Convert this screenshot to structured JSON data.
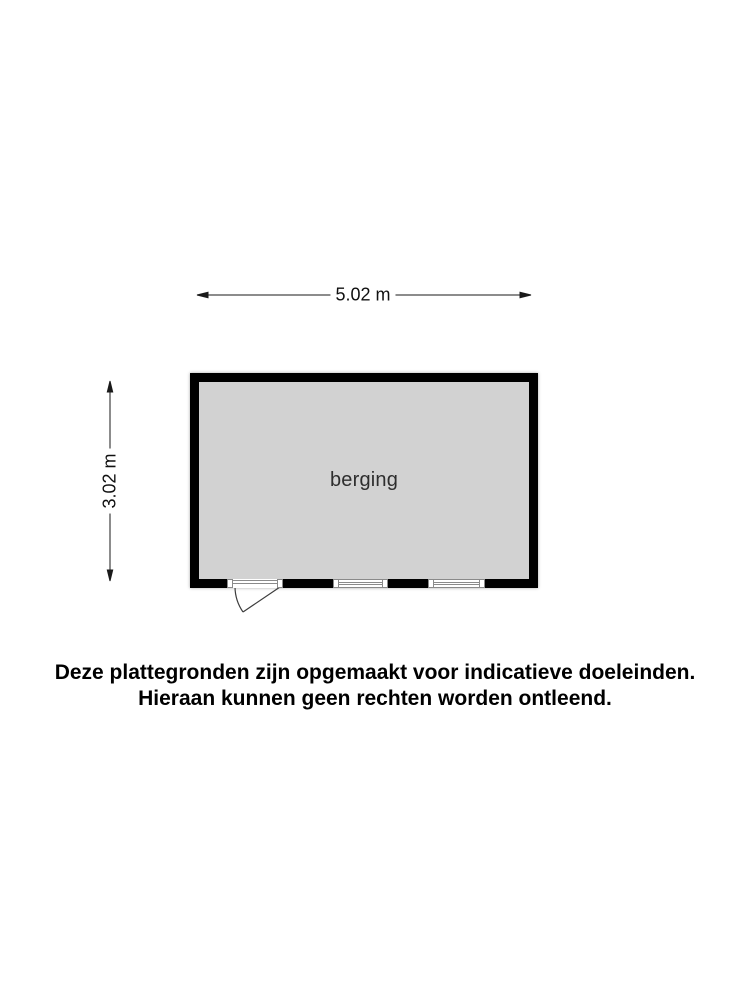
{
  "floorplan": {
    "room": {
      "label": "berging"
    },
    "dimensions": {
      "width_label": "5.02 m",
      "height_label": "3.02 m"
    }
  },
  "disclaimer": {
    "line1": "Deze plattegronden zijn opgemaakt voor indicatieve doeleinden.",
    "line2": "Hieraan kunnen geen rechten worden ontleend."
  },
  "colors": {
    "background": "#ffffff",
    "wall": "#000000",
    "room_fill": "#d2d2d2",
    "dimension_line": "#1a1a1a",
    "frame_gray": "#8a8a8a",
    "text": "#111111"
  }
}
